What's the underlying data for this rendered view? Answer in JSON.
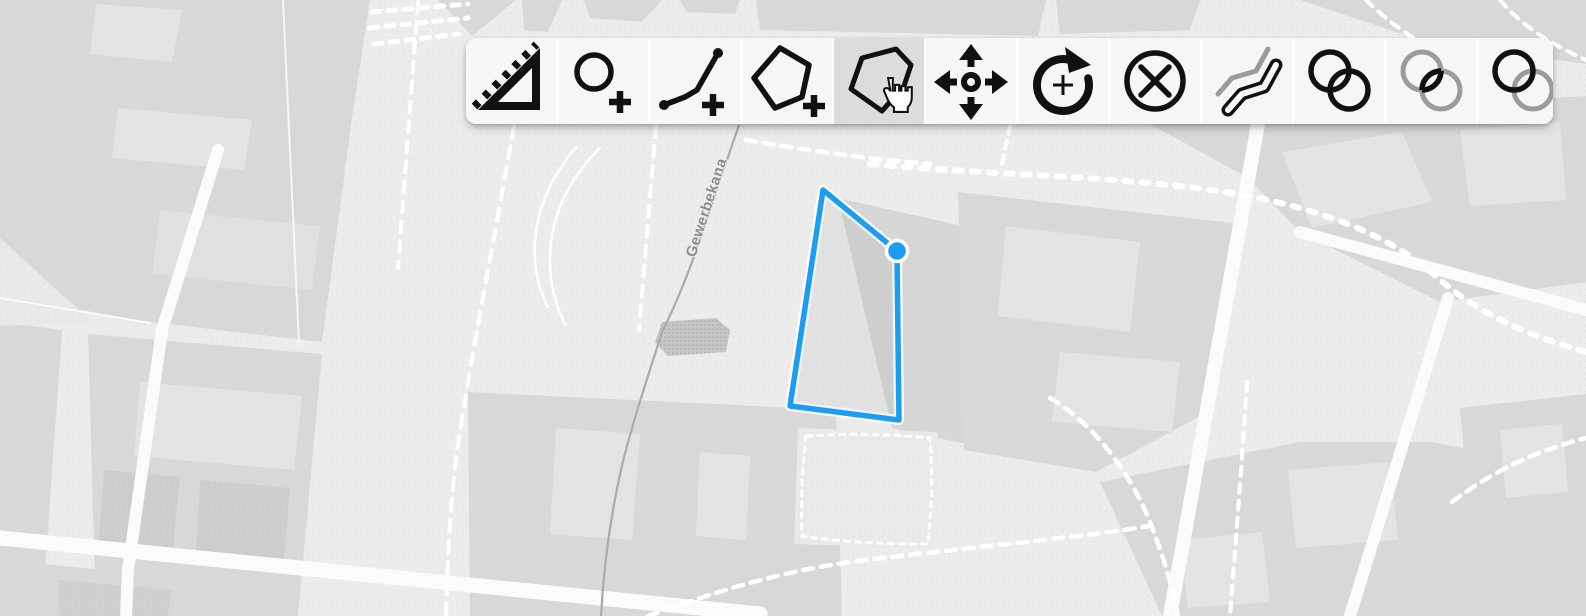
{
  "toolbar": {
    "position": {
      "left": 466,
      "top": 38,
      "width": 1087,
      "height": 86
    },
    "background": "#f6f6f6",
    "active_background": "#dcdcdc",
    "tools": [
      {
        "id": "measure",
        "icon": "ruler-triangle-icon",
        "active": false
      },
      {
        "id": "draw-circle",
        "icon": "circle-plus-icon",
        "active": false
      },
      {
        "id": "draw-line",
        "icon": "polyline-plus-icon",
        "active": false
      },
      {
        "id": "draw-polygon",
        "icon": "polygon-plus-icon",
        "active": false
      },
      {
        "id": "modify-feature",
        "icon": "polygon-hand-cursor-icon",
        "active": true
      },
      {
        "id": "move-feature",
        "icon": "move-arrows-icon",
        "active": false
      },
      {
        "id": "rotate-feature",
        "icon": "rotate-arrow-plus-icon",
        "active": false
      },
      {
        "id": "delete-feature",
        "icon": "circle-x-icon",
        "active": false
      },
      {
        "id": "offset-line",
        "icon": "parallel-lines-icon",
        "active": false
      },
      {
        "id": "boolean-union",
        "icon": "overlapping-circles-union-icon",
        "active": false
      },
      {
        "id": "boolean-intersection",
        "icon": "overlapping-circles-intersection-icon",
        "active": false
      },
      {
        "id": "boolean-difference",
        "icon": "overlapping-circles-difference-icon",
        "active": false
      }
    ]
  },
  "map": {
    "street_label": "Gewerbekana",
    "feature": {
      "type": "polygon",
      "stroke_color": "#1b9df0",
      "casing_color": "#ffffff",
      "fill_color": "rgba(110,110,110,0.08)",
      "vertices": [
        [
          823,
          190
        ],
        [
          897,
          251
        ],
        [
          899,
          420
        ],
        [
          790,
          406
        ]
      ],
      "active_vertex": [
        897,
        251
      ]
    },
    "colors": {
      "background": "#ececec",
      "block": "#d8d8d8",
      "road": "#fbfbfb",
      "label": "#8d8d8d"
    }
  }
}
